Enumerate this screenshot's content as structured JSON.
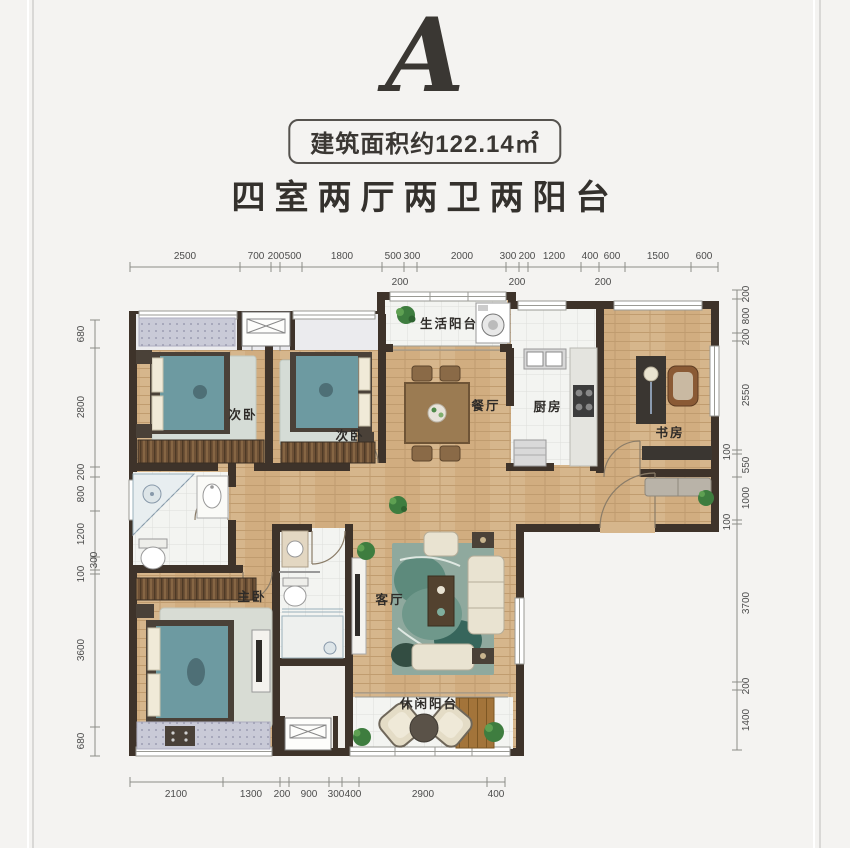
{
  "header": {
    "plan_letter": "A",
    "area_label": "建筑面积约122.14㎡",
    "layout_title": "四室两厅两卫两阳台"
  },
  "rooms": {
    "bedroom_left": "次卧",
    "bedroom_right": "次卧",
    "life_balcony": "生活阳台",
    "dining": "餐厅",
    "kitchen": "厨房",
    "study": "书房",
    "master_bedroom": "主卧",
    "living": "客厅",
    "leisure_balcony": "休闲阳台"
  },
  "dims": {
    "top": [
      "2500",
      "700",
      "200",
      "500",
      "1800",
      "500",
      "300",
      "2000",
      "300",
      "200",
      "1200",
      "400",
      "600",
      "1500",
      "600"
    ],
    "top_sub": [
      "200",
      "200",
      "200"
    ],
    "left": [
      "680",
      "2800",
      "200",
      "800",
      "1200",
      "300",
      "100",
      "3600",
      "680"
    ],
    "right": [
      "200",
      "800",
      "200",
      "2550",
      "100",
      "550",
      "1000",
      "100",
      "3700",
      "200",
      "1400"
    ],
    "bottom": [
      "2100",
      "1300",
      "200",
      "900",
      "300",
      "400",
      "2900",
      "400"
    ]
  },
  "colors": {
    "wall": "#3e332a",
    "wood_floor": "#d6b68c",
    "bed_teal": "#6d9aa1",
    "background": "#f4f3f1",
    "dim_text": "#4c4c4c"
  }
}
